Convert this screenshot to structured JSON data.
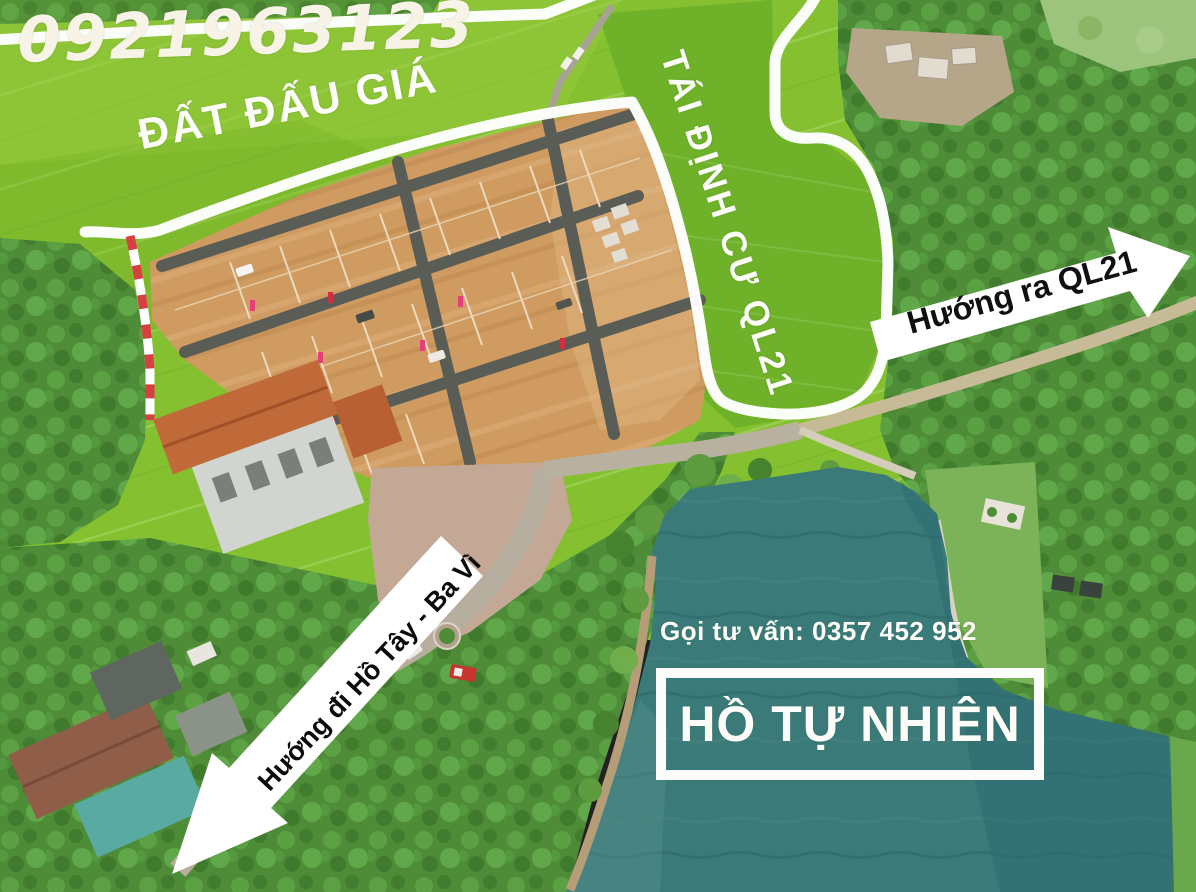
{
  "overlay": {
    "phone_handwritten": "0921963123",
    "auction_area_label": "ĐẤT ĐẤU GIÁ",
    "resettlement_label": "TÁI ĐỊNH CƯ QL21",
    "direction_ql21": "Hướng ra QL21",
    "direction_hotay": "Hướng đi Hồ Tây - Ba Vì",
    "consult_line": "Gọi tư vấn: 0357 452 952",
    "lake_label": "HỒ TỰ NHIÊN"
  },
  "colors": {
    "rice_field_green": "#84c02f",
    "resettlement_field_green": "#6fb22a",
    "forest_green": "#4e8c37",
    "soil_plots_tan": "#cf9b61",
    "lake_teal": "#3a7b7a",
    "boundary_outline": "#ffffff",
    "flag_strip_red": "#d64040",
    "arrow_fill": "#ffffff",
    "arrow_text": "#0c0c0c",
    "overlay_text": "#fcfcf8"
  }
}
